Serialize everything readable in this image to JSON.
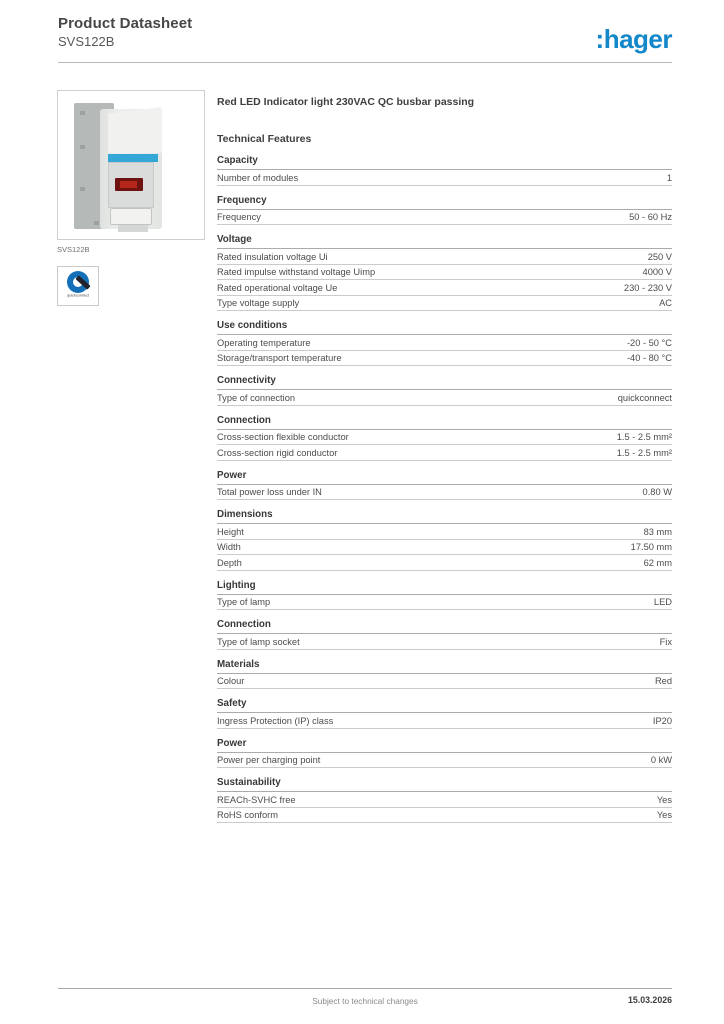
{
  "header": {
    "title": "Product Datasheet",
    "subtitle": "SVS122B",
    "logo_text": ":hager"
  },
  "product": {
    "image_caption": "SVS122B",
    "badge_label": "quickconnect",
    "title": "Red LED Indicator light 230VAC QC busbar passing",
    "features_heading": "Technical Features"
  },
  "sections": [
    {
      "title": "Capacity",
      "rows": [
        {
          "label": "Number of modules",
          "value": "1"
        }
      ]
    },
    {
      "title": "Frequency",
      "rows": [
        {
          "label": "Frequency",
          "value": "50 - 60 Hz"
        }
      ]
    },
    {
      "title": "Voltage",
      "rows": [
        {
          "label": "Rated insulation voltage Ui",
          "value": "250 V"
        },
        {
          "label": "Rated impulse withstand voltage Uimp",
          "value": "4000 V"
        },
        {
          "label": "Rated operational voltage Ue",
          "value": "230 - 230 V"
        },
        {
          "label": "Type voltage supply",
          "value": "AC"
        }
      ]
    },
    {
      "title": "Use conditions",
      "rows": [
        {
          "label": "Operating temperature",
          "value": "-20 - 50 °C"
        },
        {
          "label": "Storage/transport temperature",
          "value": "-40 - 80 °C"
        }
      ]
    },
    {
      "title": "Connectivity",
      "rows": [
        {
          "label": "Type of connection",
          "value": "quickconnect"
        }
      ]
    },
    {
      "title": "Connection",
      "rows": [
        {
          "label": "Cross-section flexible conductor",
          "value": "1.5 - 2.5 mm²"
        },
        {
          "label": "Cross-section rigid conductor",
          "value": "1.5 - 2.5 mm²"
        }
      ]
    },
    {
      "title": "Power",
      "rows": [
        {
          "label": "Total power loss under IN",
          "value": "0.80 W"
        }
      ]
    },
    {
      "title": "Dimensions",
      "rows": [
        {
          "label": "Height",
          "value": "83 mm"
        },
        {
          "label": "Width",
          "value": "17.50 mm"
        },
        {
          "label": "Depth",
          "value": "62 mm"
        }
      ]
    },
    {
      "title": "Lighting",
      "rows": [
        {
          "label": "Type of lamp",
          "value": "LED"
        }
      ]
    },
    {
      "title": "Connection",
      "rows": [
        {
          "label": "Type of lamp socket",
          "value": "Fix"
        }
      ]
    },
    {
      "title": "Materials",
      "rows": [
        {
          "label": "Colour",
          "value": "Red"
        }
      ]
    },
    {
      "title": "Safety",
      "rows": [
        {
          "label": "Ingress Protection (IP) class",
          "value": "IP20"
        }
      ]
    },
    {
      "title": "Power",
      "rows": [
        {
          "label": "Power per charging point",
          "value": "0 kW"
        }
      ]
    },
    {
      "title": "Sustainability",
      "rows": [
        {
          "label": "REACh-SVHC free",
          "value": "Yes"
        },
        {
          "label": "RoHS conform",
          "value": "Yes"
        }
      ]
    }
  ],
  "footer": {
    "note": "Subject to technical changes",
    "date": "15.03.2026"
  },
  "colors": {
    "brand_blue": "#1287c9",
    "led_red": "#b5261b",
    "label_strip_blue": "#35a7d7"
  }
}
